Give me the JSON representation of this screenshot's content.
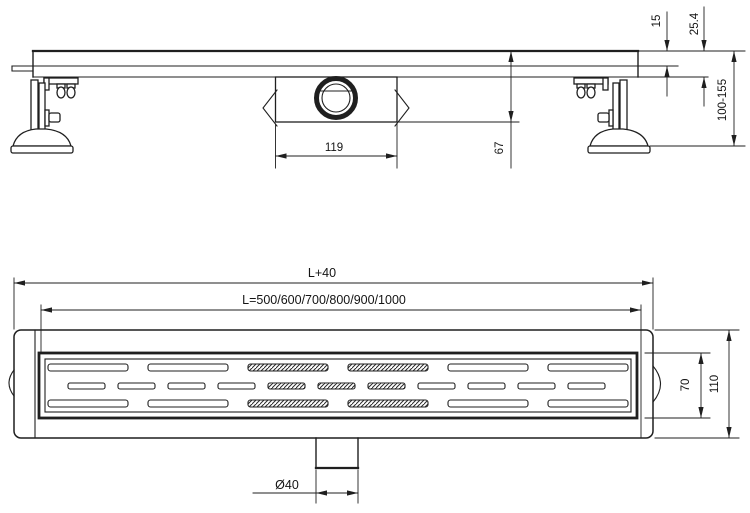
{
  "drawing": {
    "kind": "technical drawing - linear shower drain channel",
    "line_color": "#1f1f1f",
    "background": "#ffffff"
  },
  "side_view": {
    "dim_trap_width": "119",
    "dim_trap_depth": "67",
    "dim_grate_edge": "15",
    "dim_channel_edge": "25.4",
    "dim_height_range": "100-155"
  },
  "plan_view": {
    "dim_overall_length": "L+40",
    "dim_channel_lengths": "L=500/600/700/800/900/1000",
    "dim_grate_width": "70",
    "dim_overall_width": "110",
    "dim_outlet_diameter": "Ø40"
  }
}
